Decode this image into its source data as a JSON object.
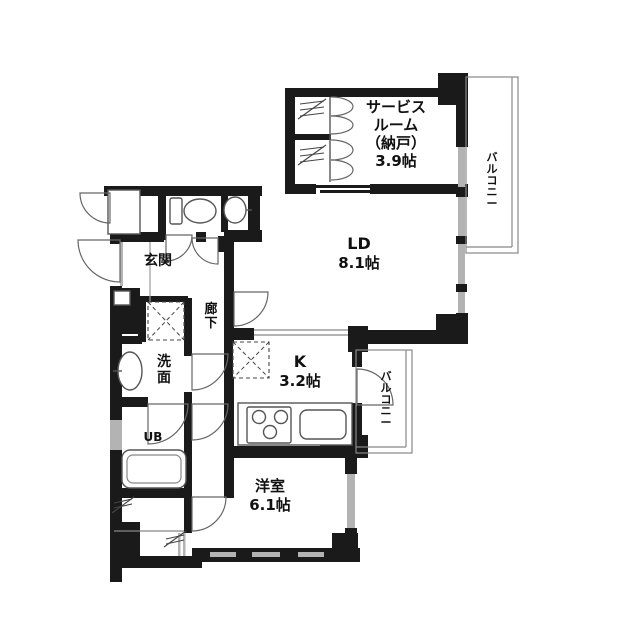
{
  "plan": {
    "type": "floor-plan",
    "rooms": {
      "service_room": {
        "line1": "サービス",
        "line2": "ルーム",
        "line3": "（納戸）",
        "size": "3.9帖"
      },
      "living_dining": {
        "label": "LD",
        "size": "8.1帖"
      },
      "kitchen": {
        "label": "K",
        "size": "3.2帖"
      },
      "western_room": {
        "label": "洋室",
        "size": "6.1帖"
      },
      "entrance": {
        "label": "玄関"
      },
      "corridor": {
        "label": "廊下"
      },
      "washroom": {
        "label": "洗面"
      },
      "unit_bath": {
        "label": "UB"
      },
      "balcony_right": {
        "label": "バルコニー"
      },
      "balcony_lower": {
        "label": "バルコニー"
      }
    },
    "colors": {
      "wall": "#1a1a1a",
      "line": "#555555",
      "window": "#b3b3b3",
      "background": "#ffffff",
      "text": "#111111"
    }
  }
}
